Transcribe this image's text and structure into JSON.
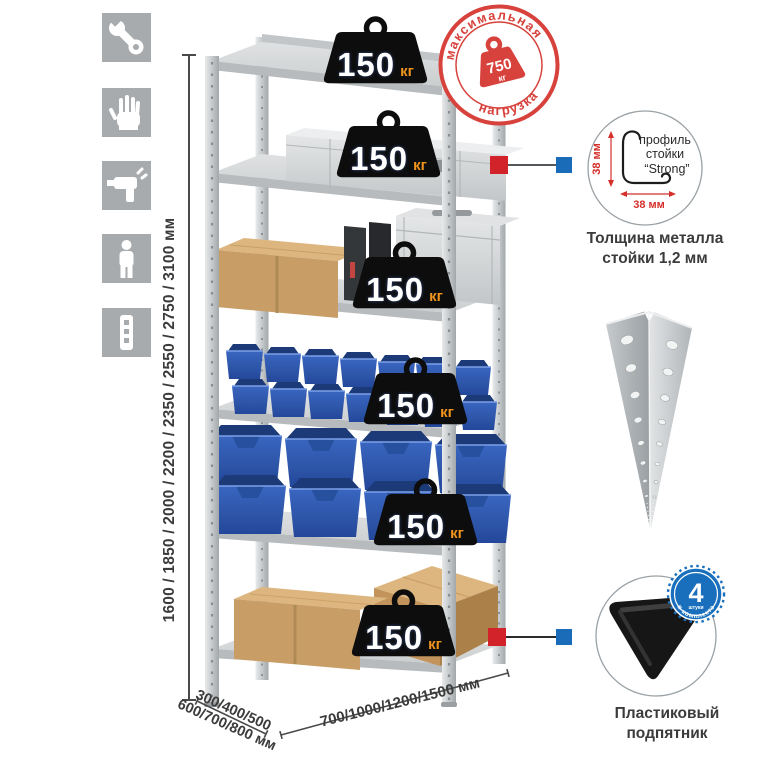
{
  "sidebar": {
    "icons": [
      {
        "name": "wrench-icon"
      },
      {
        "name": "gloves-icon"
      },
      {
        "name": "drill-icon"
      },
      {
        "name": "person-icon"
      },
      {
        "name": "profile-strip-icon"
      }
    ]
  },
  "dimensions": {
    "height": "1600 / 1850 / 2000 / 2200 / 2350 / 2550 / 2750 / 3100 мм",
    "depth_line1": "300/400/500",
    "depth_line2": "600/700/800 мм",
    "width": "700/1000/1200/1500 мм"
  },
  "illustration": {
    "shelf_load_badges": [
      {
        "value": "150",
        "unit": "кг"
      },
      {
        "value": "150",
        "unit": "кг"
      },
      {
        "value": "150",
        "unit": "кг"
      },
      {
        "value": "150",
        "unit": "кг"
      },
      {
        "value": "150",
        "unit": "кг"
      },
      {
        "value": "150",
        "unit": "кг"
      }
    ]
  },
  "stamp": {
    "arc_top": "максимальная",
    "arc_bottom": "нагрузка",
    "value": "750",
    "unit": "кг"
  },
  "profile_callout": {
    "label_line1": "профиль",
    "label_line2": "стойки",
    "label_line3": "“Strong”",
    "dim_vertical": "38 мм",
    "dim_horizontal": "38 мм",
    "caption_line1": "Толщина металла",
    "caption_line2": "стойки 1,2 мм"
  },
  "foot_callout": {
    "badge_value": "4",
    "badge_small": "штуки",
    "badge_arc": "в комплекте",
    "caption_line1": "Пластиковый",
    "caption_line2": "подпятник"
  },
  "colors": {
    "stamp_red": "#d8423c",
    "connector_red": "#d2232a",
    "connector_blue": "#1a6cb8",
    "badge_black": "#0d0d0d",
    "unit_orange": "#f0941d",
    "bin_blue": "#2f5cb4",
    "icon_tile_gray": "#a7abad",
    "metal_light": "#d8dadb",
    "text_dark": "#3b3b3b"
  }
}
